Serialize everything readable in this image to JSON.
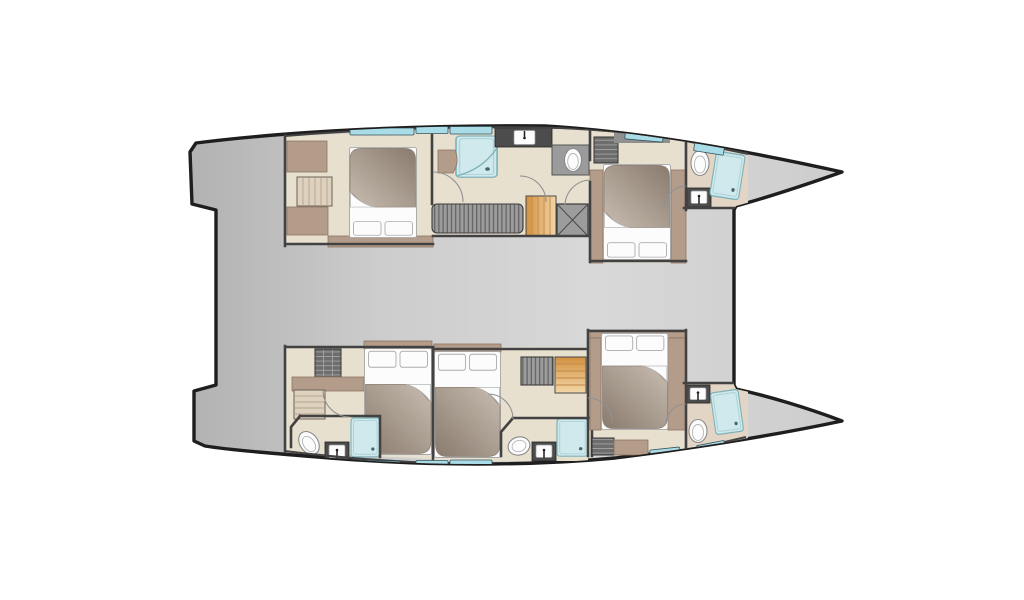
{
  "plan": {
    "title": "Catamaran yacht deck layout plan",
    "vessel": "catamaran",
    "view": "top-down floor plan",
    "orientation": "bows pointing right, transoms left",
    "hulls": [
      {
        "name": "upper hull",
        "position": "top",
        "rooms": [
          {
            "id": "upper-aft-cabin",
            "type": "cabin",
            "furniture": [
              "double-bed",
              "wardrobe",
              "steps",
              "cabinet",
              "window"
            ]
          },
          {
            "id": "upper-mid-bathroom",
            "type": "bathroom",
            "furniture": [
              "shower",
              "vanity-seat",
              "sink-counter",
              "toilet"
            ]
          },
          {
            "id": "upper-corridor",
            "type": "passage",
            "furniture": [
              "slatted-bench",
              "companionway-stairs",
              "storage-box",
              "shelf-unit"
            ]
          },
          {
            "id": "upper-forward-cabin",
            "type": "cabin",
            "furniture": [
              "double-bed",
              "side-lockers",
              "roof-window"
            ]
          },
          {
            "id": "upper-bow-bathroom",
            "type": "bathroom",
            "furniture": [
              "toilet",
              "sink",
              "shower",
              "window"
            ]
          }
        ]
      },
      {
        "name": "lower hull",
        "position": "bottom",
        "rooms": [
          {
            "id": "lower-aft-cabin",
            "type": "cabin",
            "furniture": [
              "double-bed",
              "shelf-unit",
              "dresser",
              "steps",
              "window"
            ]
          },
          {
            "id": "lower-aft-bathroom",
            "type": "bathroom",
            "furniture": [
              "toilet",
              "sink",
              "shower"
            ]
          },
          {
            "id": "lower-mid-cabin",
            "type": "cabin",
            "furniture": [
              "double-bed",
              "shelf-unit",
              "companionway-stairs"
            ]
          },
          {
            "id": "lower-mid-bathroom",
            "type": "bathroom",
            "furniture": [
              "toilet",
              "sink",
              "shower"
            ]
          },
          {
            "id": "lower-forward-cabin",
            "type": "cabin",
            "furniture": [
              "double-bed",
              "side-lockers",
              "shelf-unit",
              "window"
            ]
          },
          {
            "id": "lower-bow-bathroom",
            "type": "bathroom",
            "furniture": [
              "sink",
              "toilet",
              "shower"
            ]
          }
        ]
      }
    ],
    "bridgedeck": {
      "id": "bridgedeck",
      "note": "open gray deck between hulls, recessed transom step aft"
    },
    "counts": {
      "cabins": 5,
      "bathrooms": 5,
      "beds": 5,
      "showers": 5,
      "toilets": 5,
      "sinks": 5
    }
  },
  "colors": {
    "background": "#ffffff",
    "outline": "#1e1e1e",
    "deck_dark": "#b2b2b2",
    "deck_mid": "#cdcdcd",
    "deck_light": "#d8d8d8",
    "floor": "#e8e0cf",
    "floor_warm": "#e3d5c5",
    "wall": "#424242",
    "furniture": "#b49c8a",
    "furniture_edge": "#8d7462",
    "linen": "#fcfcfc",
    "duvet_dark": "#897b6e",
    "duvet_light": "#c8bdb1",
    "shower": "#cfe9ec",
    "shower_edge": "#7fb2ba",
    "window": "#a9dce6",
    "window_edge": "#34535c",
    "stairs_dark": "#d2913f",
    "stairs_light": "#f2d6a8",
    "steps_light": "#ded2bf",
    "steps_edge": "#b3a48f",
    "hatch_gray": "#9c9c9c",
    "hatch_dark": "#6d6d6d",
    "counter": "#4c4c4c",
    "door_arc": "#909090"
  }
}
